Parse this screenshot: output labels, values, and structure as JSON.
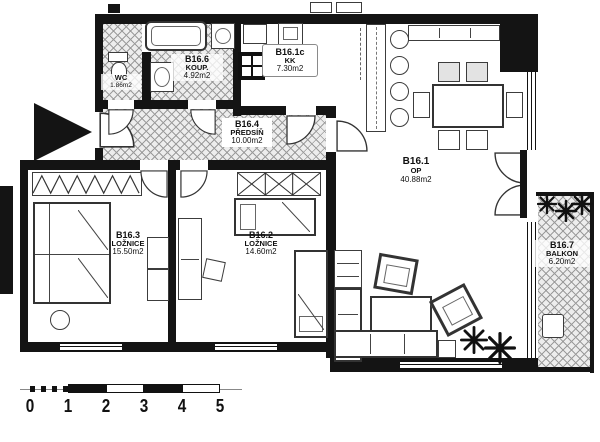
{
  "rooms": {
    "wc": {
      "name": "WC",
      "area": "1.86m2"
    },
    "koup": {
      "id": "B16.6",
      "name": "KOUP.",
      "area": "4.92m2"
    },
    "kk": {
      "id": "B16.1c",
      "name": "KK",
      "area": "7.30m2"
    },
    "predsin": {
      "id": "B16.4",
      "name": "PŘEDSÍŇ",
      "area": "10.00m2"
    },
    "op": {
      "id": "B16.1",
      "name": "OP",
      "area": "40.88m2"
    },
    "loznice3": {
      "id": "B16.3",
      "name": "LOŽNICE",
      "area": "15.50m2"
    },
    "loznice2": {
      "id": "B16.2",
      "name": "LOŽNICE",
      "area": "14.60m2"
    },
    "balkon": {
      "id": "B16.7",
      "name": "BALKON",
      "area": "6.20m2"
    }
  },
  "scale_bar": {
    "unit_ticks": [
      "0",
      "1",
      "2",
      "3",
      "4",
      "5"
    ]
  },
  "colors": {
    "wall": "#141414",
    "hatch_line": "#9b9b9b",
    "furniture": "#3c3c3c",
    "paper": "#ffffff"
  }
}
